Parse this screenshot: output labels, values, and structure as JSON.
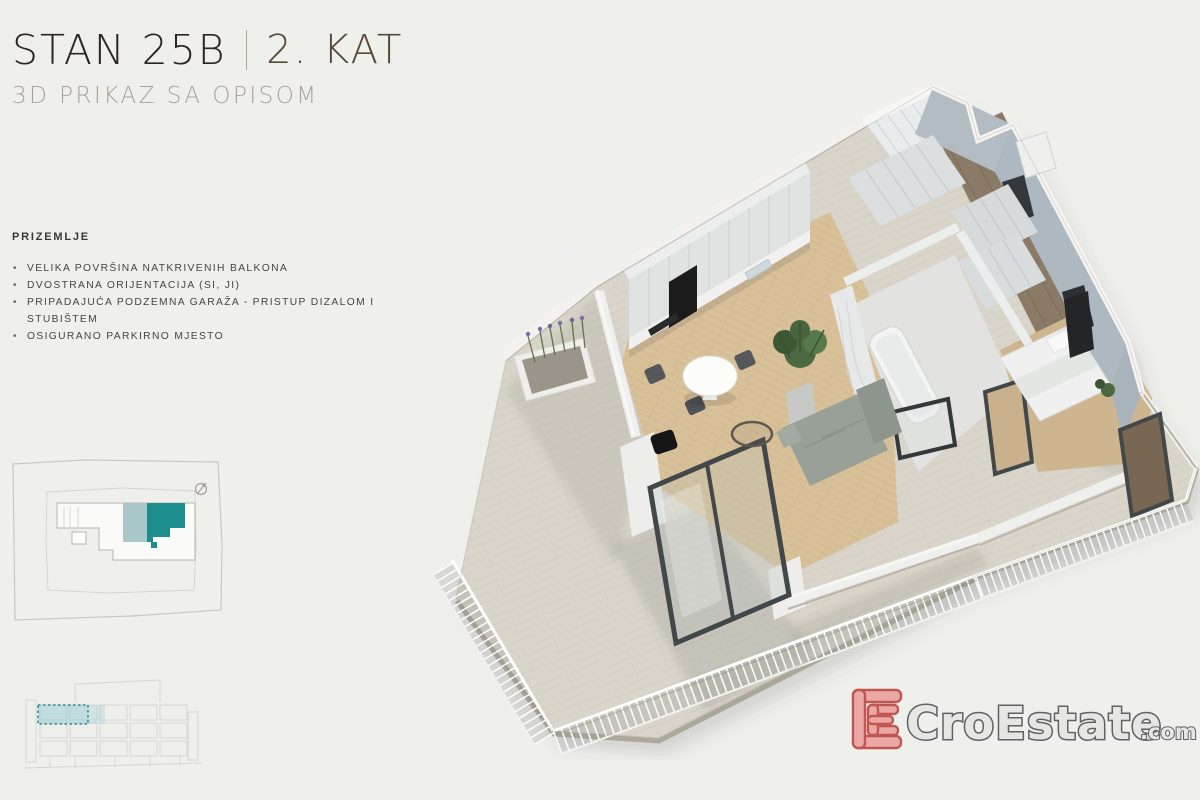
{
  "header": {
    "unit": "STAN 25B",
    "floor": "2. KAT",
    "subtitle": "3D PRIKAZ SA OPISOM"
  },
  "description": {
    "heading": "PRIZEMLJE",
    "bullets": [
      "VELIKA POVRŠINA NATKRIVENIH BALKONA",
      "DVOSTRANA ORIJENTACIJA (SI, JI)",
      "PRIPADAJUĆA PODZEMNA GARAŽA - PRISTUP DIZALOM I STUBIŠTEM",
      "OSIGURANO PARKIRNO MJESTO"
    ]
  },
  "site_plan": {
    "highlight_color": "#1d8d8e",
    "highlight_secondary_color": "#a9c6c9",
    "outline_color": "#c9c7c1"
  },
  "elevation": {
    "highlight_color": "#2a8f95",
    "highlight_fill": "#9fcdd4"
  },
  "watermark": {
    "brand": "CroEstate",
    "tld": ".com",
    "mark_fill": "#eba3a0",
    "mark_stroke": "#bc4a46",
    "text_fill": "#e6e6e4",
    "text_stroke": "#54545a"
  }
}
